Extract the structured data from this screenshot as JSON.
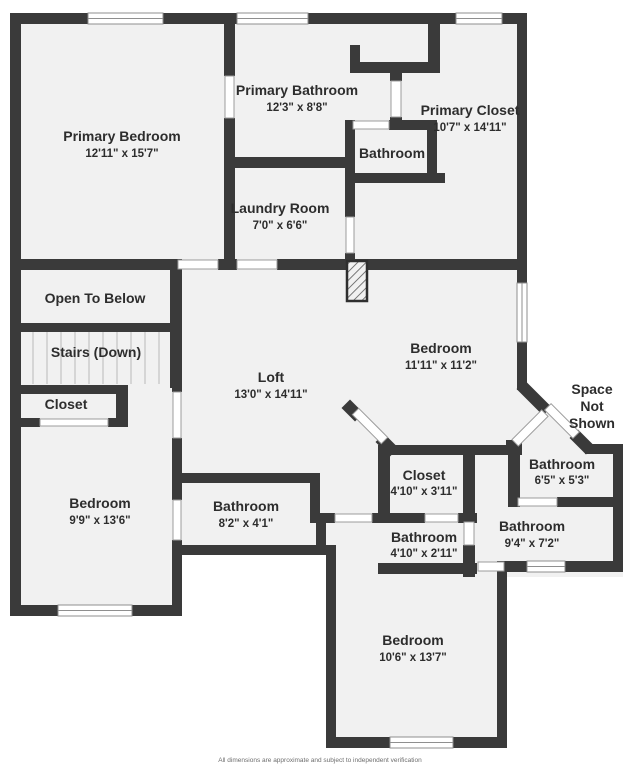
{
  "title": "Second floor plan",
  "colors": {
    "wall": "#3a3a3a",
    "floor": "#f1f1f1",
    "text": "#2d2d2d",
    "doorstroke": "#9c9c9c",
    "windowstroke": "#8f8f8f",
    "tread": "#cccccc",
    "muted": "#6e6e6e"
  },
  "rooms": {
    "primary_bedroom": {
      "name": "Primary Bedroom",
      "dims": "12'11\" x 15'7\""
    },
    "primary_bathroom": {
      "name": "Primary Bathroom",
      "dims": "12'3\" x 8'8\""
    },
    "primary_wc": {
      "name": "Bathroom"
    },
    "primary_closet": {
      "name": "Primary Closet",
      "dims": "10'7\" x 14'11\""
    },
    "laundry": {
      "name": "Laundry Room",
      "dims": "7'0\" x 6'6\""
    },
    "open_to_below": {
      "name": "Open To Below"
    },
    "stairs": {
      "name": "Stairs (Down)"
    },
    "closet_hall": {
      "name": "Closet"
    },
    "loft": {
      "name": "Loft",
      "dims": "13'0\" x 14'11\""
    },
    "bedroom_ne": {
      "name": "Bedroom",
      "dims": "11'11\" x 11'2\""
    },
    "space_not_shown": {
      "line1": "Space",
      "line2": "Not",
      "line3": "Shown"
    },
    "bedroom_w": {
      "name": "Bedroom",
      "dims": "9'9\" x 13'6\""
    },
    "bathroom_w": {
      "name": "Bathroom",
      "dims": "8'2\" x 4'1\""
    },
    "closet_s": {
      "name": "Closet",
      "dims": "4'10\" x 3'11\""
    },
    "bathroom_s": {
      "name": "Bathroom",
      "dims": "4'10\" x 2'11\""
    },
    "bathroom_e": {
      "name": "Bathroom",
      "dims": "6'5\" x 5'3\""
    },
    "bathroom_se": {
      "name": "Bathroom",
      "dims": "9'4\" x 7'2\""
    },
    "bedroom_s": {
      "name": "Bedroom",
      "dims": "10'6\" x 13'7\""
    }
  },
  "footer": "All dimensions are approximate and subject to independent verification"
}
